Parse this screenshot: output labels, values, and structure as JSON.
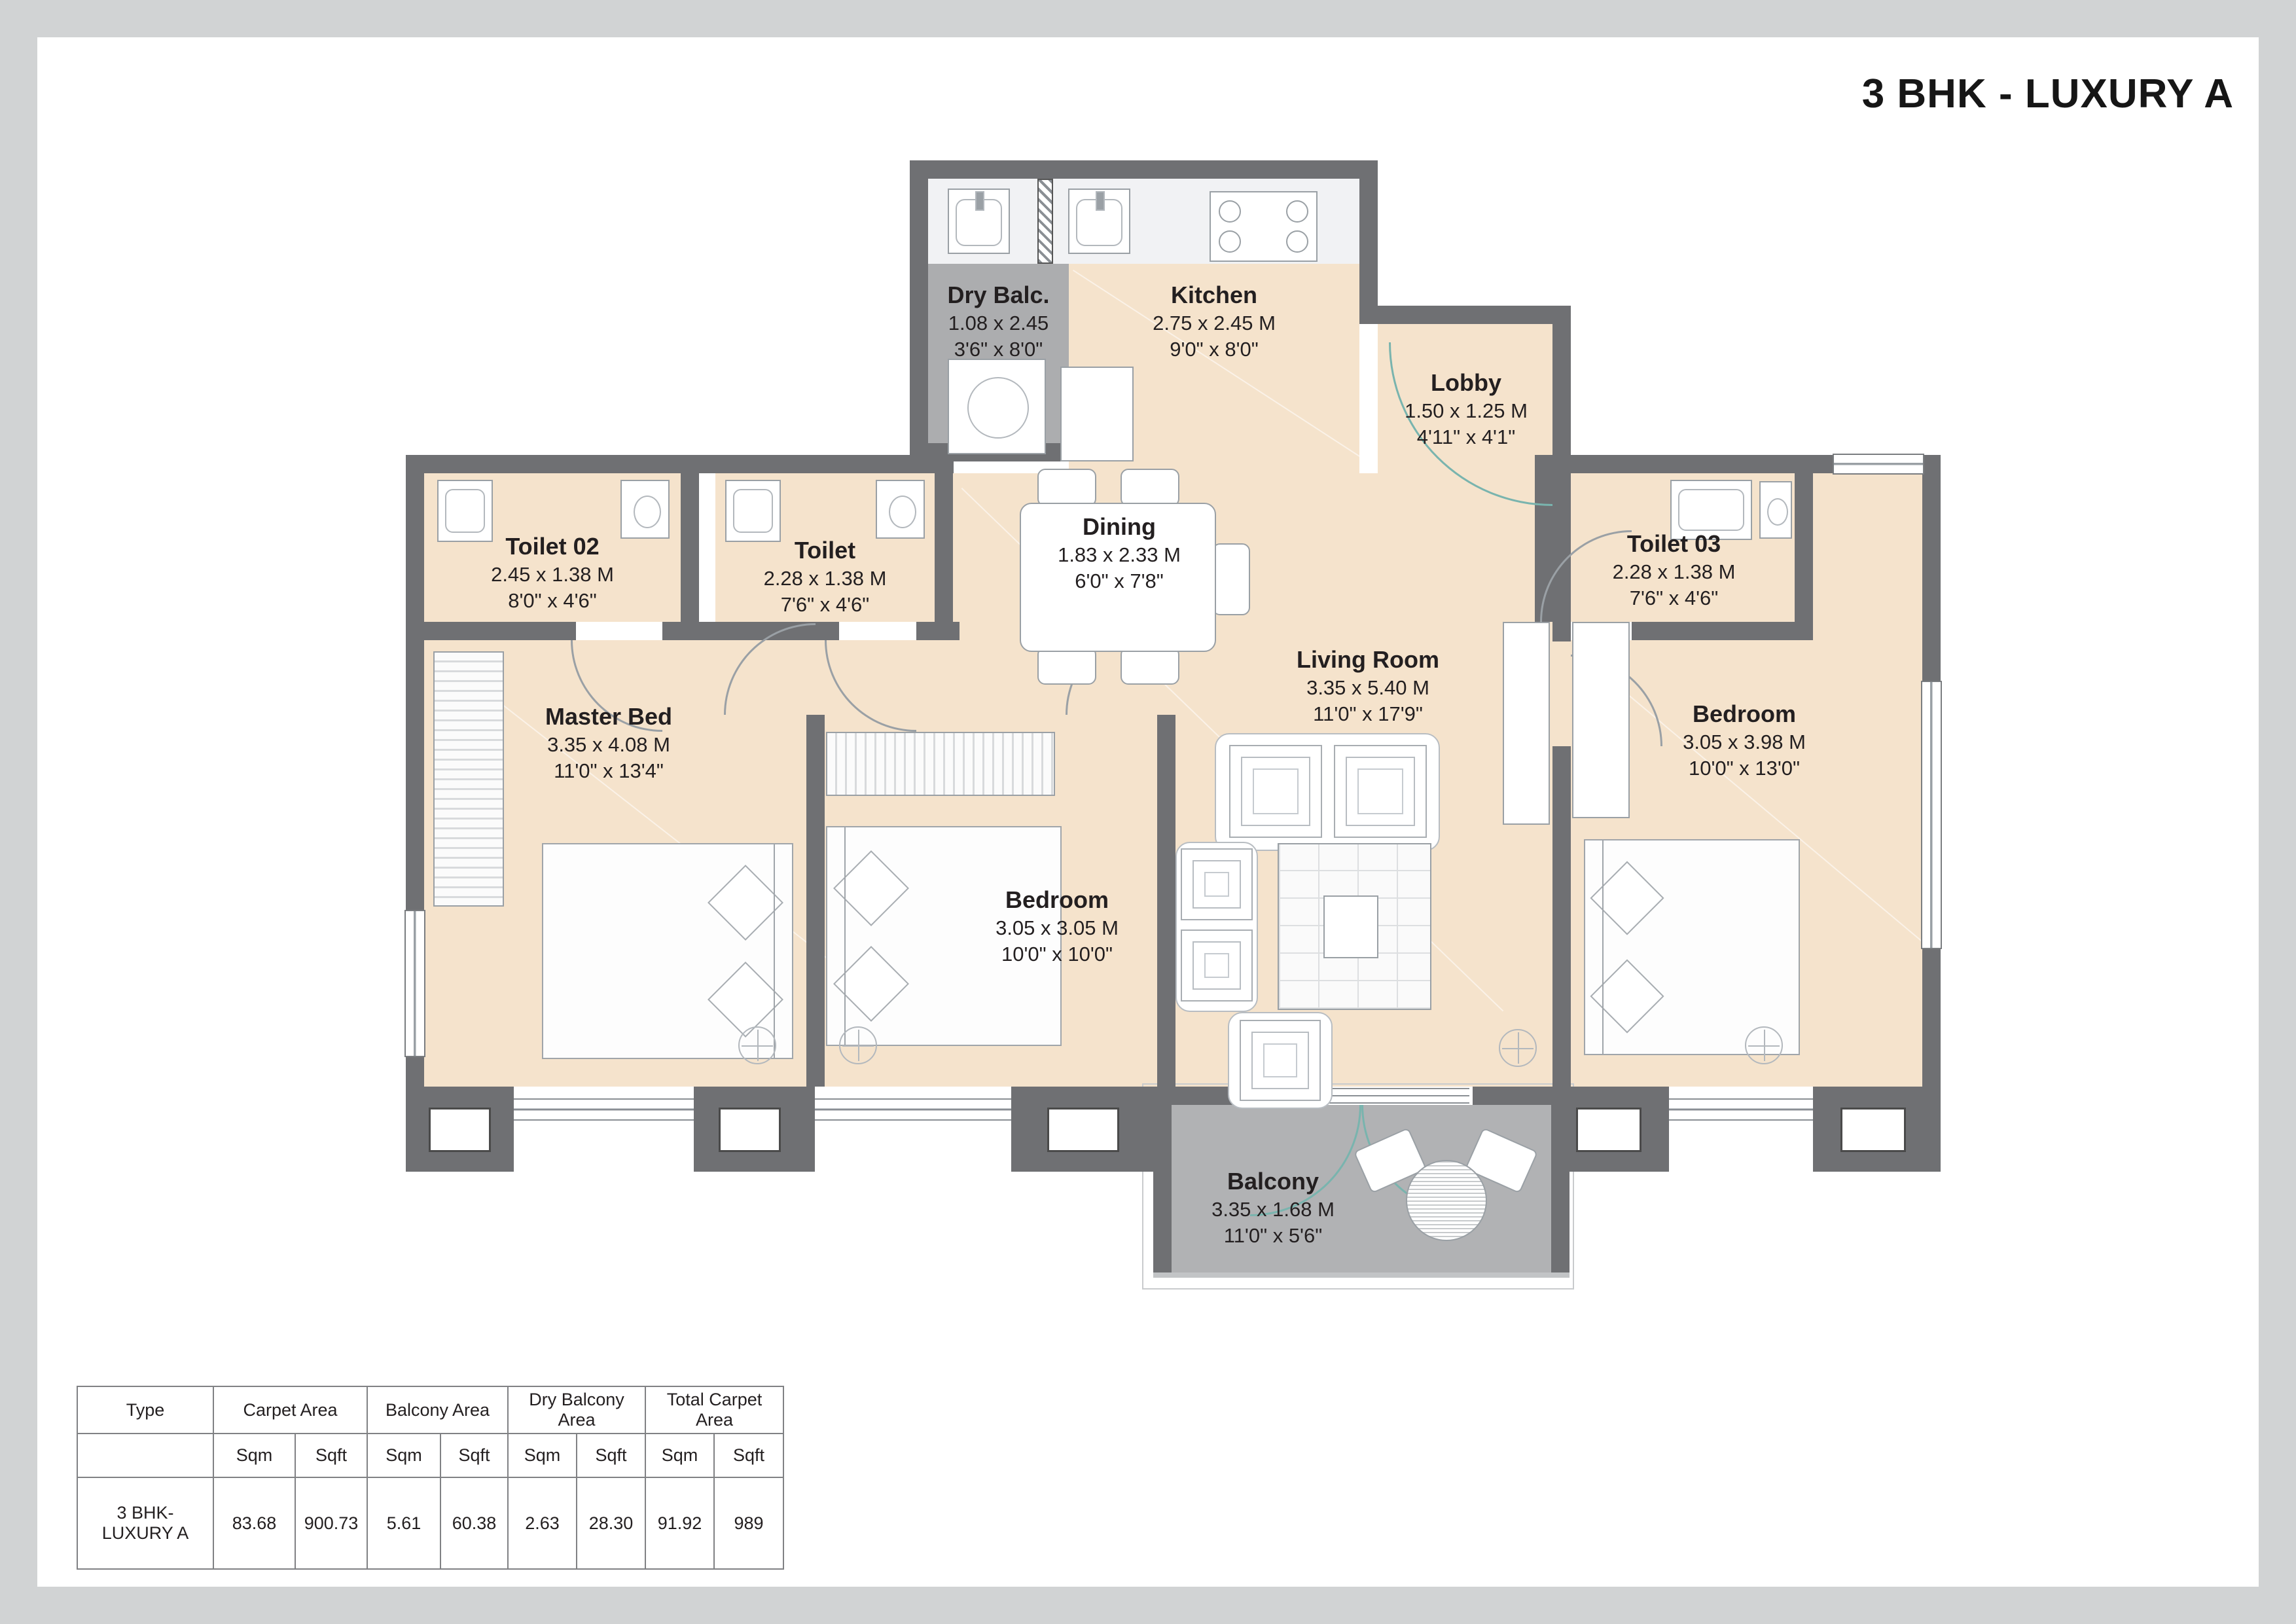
{
  "title": "3 BHK - LUXURY A",
  "rooms": [
    {
      "name": "Dry Balc.",
      "dim_m": "1.08 x 2.45",
      "dim_ft": "3'6\" x 8'0\""
    },
    {
      "name": "Kitchen",
      "dim_m": "2.75 x 2.45 M",
      "dim_ft": "9'0\" x 8'0\""
    },
    {
      "name": "Lobby",
      "dim_m": "1.50 x 1.25 M",
      "dim_ft": "4'11\" x 4'1\""
    },
    {
      "name": "Toilet 02",
      "dim_m": "2.45 x 1.38 M",
      "dim_ft": "8'0\" x 4'6\""
    },
    {
      "name": "Toilet",
      "dim_m": "2.28 x 1.38 M",
      "dim_ft": "7'6\" x 4'6\""
    },
    {
      "name": "Dining",
      "dim_m": "1.83 x 2.33 M",
      "dim_ft": "6'0\" x 7'8\""
    },
    {
      "name": "Toilet 03",
      "dim_m": "2.28 x 1.38 M",
      "dim_ft": "7'6\" x 4'6\""
    },
    {
      "name": "Master Bed",
      "dim_m": "3.35 x 4.08 M",
      "dim_ft": "11'0\" x 13'4\""
    },
    {
      "name": "Living Room",
      "dim_m": "3.35 x 5.40 M",
      "dim_ft": "11'0\" x 17'9\""
    },
    {
      "name": "Bedroom",
      "dim_m": "3.05 x 3.05 M",
      "dim_ft": "10'0\" x 10'0\""
    },
    {
      "name": "Bedroom",
      "dim_m": "3.05 x 3.98 M",
      "dim_ft": "10'0\" x 13'0\""
    },
    {
      "name": "Balcony",
      "dim_m": "3.35 x 1.68 M",
      "dim_ft": "11'0\" x 5'6\""
    }
  ],
  "table": {
    "groups": [
      "Type",
      "Carpet Area",
      "Balcony Area",
      "Dry Balcony Area",
      "Total Carpet Area"
    ],
    "units": [
      "Sqm",
      "Sqft",
      "Sqm",
      "Sqft",
      "Sqm",
      "Sqft",
      "Sqm",
      "Sqft"
    ],
    "row": {
      "type": "3 BHK-LUXURY A",
      "values": [
        "83.68",
        "900.73",
        "5.61",
        "60.38",
        "2.63",
        "28.30",
        "91.92",
        "989"
      ]
    }
  },
  "colors": {
    "wall": "#6F7073",
    "floor": "#F5E3CC",
    "balcony_floor": "#B1B2B4",
    "dry_balcony_floor": "#ACADAF",
    "page_frame": "#D1D3D4",
    "door_arc_accent": "#79B4AE",
    "text": "#231F20"
  }
}
